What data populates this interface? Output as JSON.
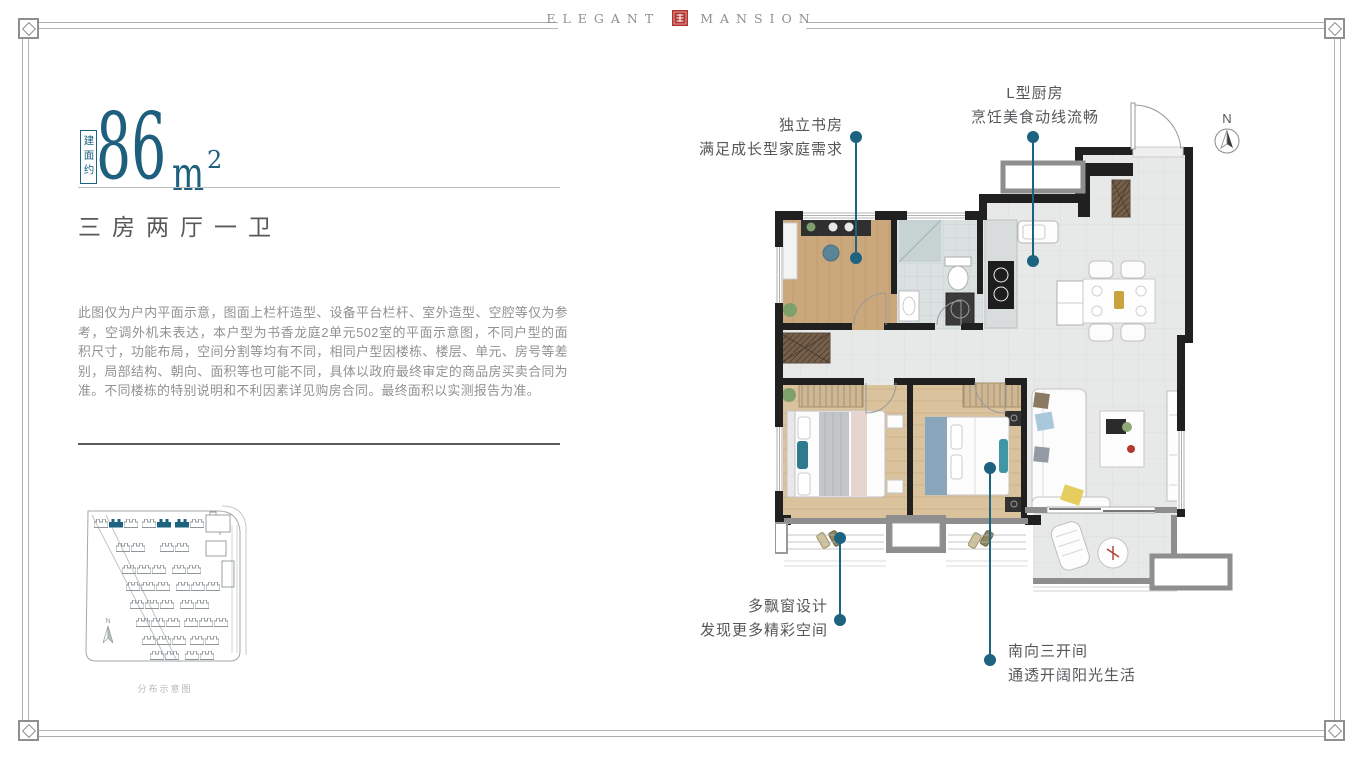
{
  "brand": {
    "name_left": "ELEGANT",
    "name_right": "MANSION"
  },
  "area_badge": {
    "prefix": "建面约",
    "value": "86",
    "unit": "m",
    "exponent": "2"
  },
  "layout": {
    "title": "三房两厅一卫"
  },
  "disclaimer": {
    "text": "此图仅为户内平面示意，图面上栏杆造型、设备平台栏杆、室外造型、空腔等仅为参考，空调外机未表达，本户型为书香龙庭2单元502室的平面示意图，不同户型的面积尺寸，功能布局，空间分割等均有不同，相同户型因楼栋、楼层、单元、房号等差别，局部结构、朝向、面积等也可能不同，具体以政府最终审定的商品房买卖合同为准。不同楼栋的特别说明和不利因素详见购房合同。最终面积以实测报告为准。"
  },
  "site_plan": {
    "caption": "分布示意图"
  },
  "floor_plan": {
    "north_label": "N"
  },
  "annotations": {
    "study": {
      "line1": "独立书房",
      "line2": "满足成长型家庭需求"
    },
    "kitchen": {
      "line1": "L型厨房",
      "line2": "烹饪美食动线流畅"
    },
    "bay_window": {
      "line1": "多飘窗设计",
      "line2": "发现更多精彩空间"
    },
    "south": {
      "line1": "南向三开间",
      "line2": "通透开阔阳光生活"
    }
  },
  "colors": {
    "accent_teal": "#1d6380",
    "seal_red": "#b23430",
    "wall_black": "#202020",
    "text_gray": "#57585a",
    "muted_gray": "#919191"
  }
}
